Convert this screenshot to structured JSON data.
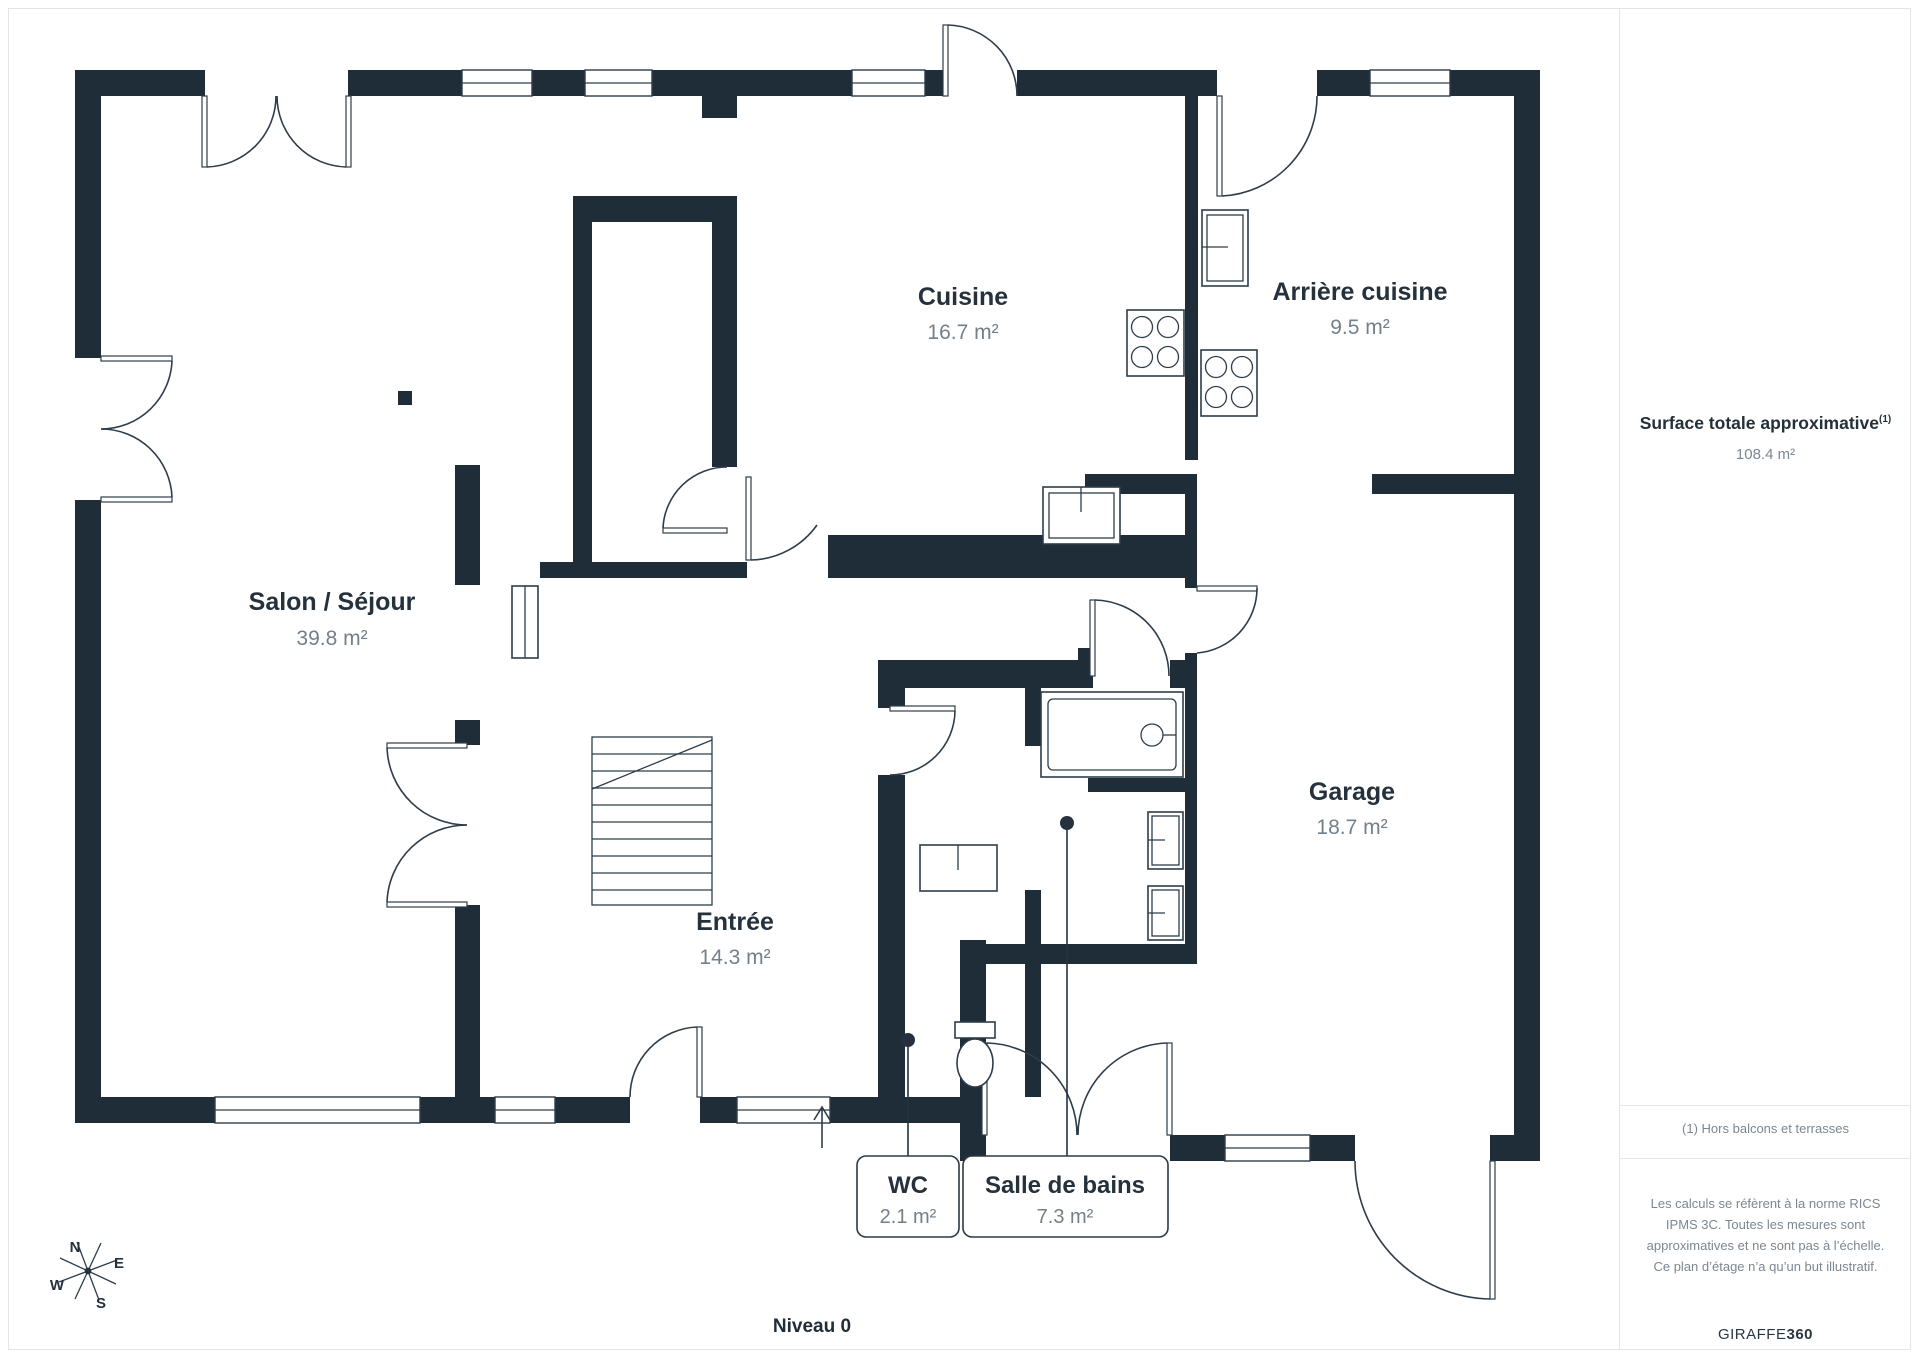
{
  "page": {
    "level_label": "Niveau 0"
  },
  "rooms": [
    {
      "id": "salon",
      "name": "Salon / Séjour",
      "area": "39.8 m²"
    },
    {
      "id": "cuisine",
      "name": "Cuisine",
      "area": "16.7 m²"
    },
    {
      "id": "arriere",
      "name": "Arrière cuisine",
      "area": "9.5 m²"
    },
    {
      "id": "entree",
      "name": "Entrée",
      "area": "14.3 m²"
    },
    {
      "id": "garage",
      "name": "Garage",
      "area": "18.7 m²"
    },
    {
      "id": "wc",
      "name": "WC",
      "area": "2.1 m²"
    },
    {
      "id": "sdb",
      "name": "Salle de bains",
      "area": "7.3 m²"
    }
  ],
  "panel": {
    "title": "Surface totale approximative",
    "title_sup": "(1)",
    "total": "108.4 m²",
    "footnote": "(1) Hors balcons et terrasses",
    "legal": "Les calculs se réfèrent à la norme RICS IPMS 3C. Toutes les mesures sont approximatives et ne sont pas à l’échelle. Ce plan d’étage n’a qu’un but illustratif.",
    "brand": "GIRAFFE",
    "brand_bold": "360"
  },
  "compass": {
    "n": "N",
    "e": "E",
    "s": "S",
    "w": "W"
  },
  "colors": {
    "wall": "#1f2d38",
    "text": "#25313c",
    "muted": "#73808a",
    "divider": "#e4e4e4"
  }
}
